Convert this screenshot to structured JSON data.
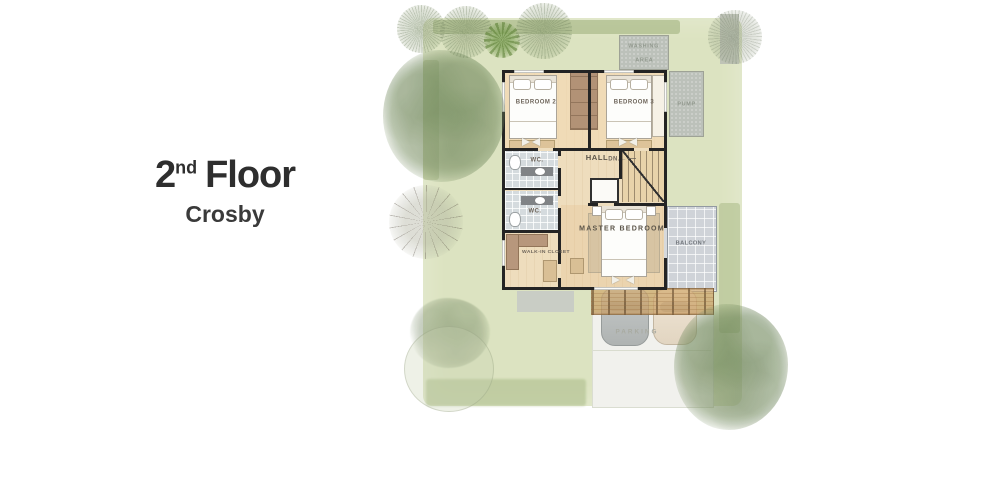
{
  "title": {
    "number": "2",
    "ordinal": "nd",
    "word": "Floor",
    "subtitle": "Crosby"
  },
  "plan": {
    "labels": {
      "bedroom2": "BEDROOM 2",
      "bedroom3": "BEDROOM 3",
      "wc_upper": "WC.",
      "wc_lower": "WC.",
      "hall": "HALL",
      "down": "DN.",
      "down_arrow": "←",
      "master_bedroom": "MASTER  BEDROOM",
      "balcony": "BALCONY",
      "walk_in_closet": "WALK-IN CLOSET",
      "washing_line1": "WASHING",
      "washing_line2": "AREA",
      "pump": "PUMP",
      "parking": "PARKING"
    },
    "colors": {
      "lawn": "#dbe3bf",
      "hedge": "#a7b884",
      "house_floor": "#eedcbb",
      "wall": "#1d1d1d",
      "wc_tile": "#d4dadd",
      "balcony_tile": "#ced2d7",
      "pergola_wood": "#c9a268",
      "driveway": "#f1f1ed",
      "service_concrete": "#babfb8",
      "title_text": "#2e2e2e",
      "label_text": "#6a6156"
    }
  }
}
